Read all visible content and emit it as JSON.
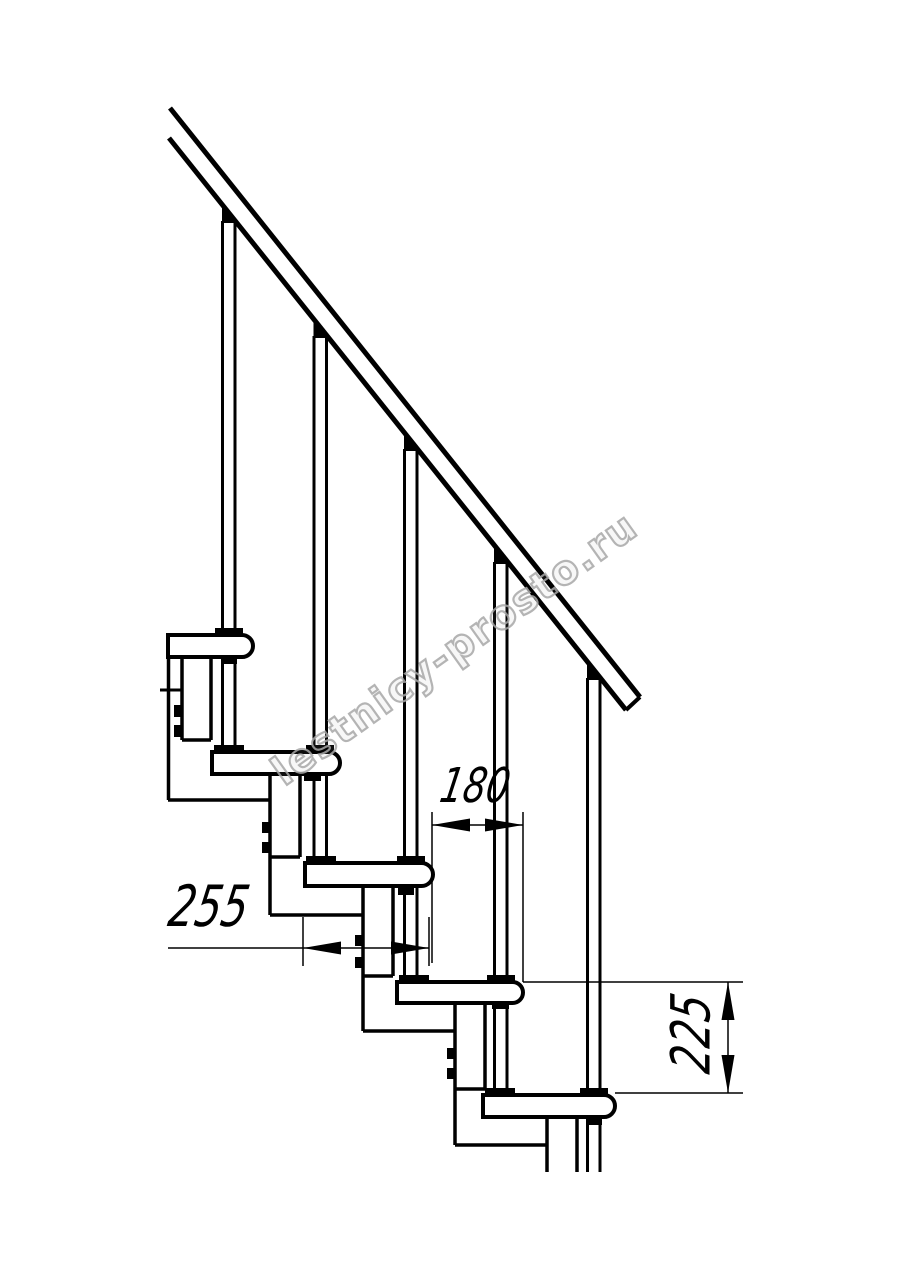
{
  "canvas": {
    "width": 914,
    "height": 1280,
    "background": "#ffffff",
    "ink": "#000000",
    "watermark_color": "#a8a8a8"
  },
  "watermark": {
    "text": "lestnicy-prosto.ru",
    "angle_deg": -35.5
  },
  "title": "Modular staircase side-view fragment with step dimensions",
  "dimensions": {
    "run_255": {
      "label": "255",
      "meaning": "tread depth, mm",
      "orientation": "horizontal"
    },
    "run_180": {
      "label": "180",
      "meaning": "step run between noses, mm",
      "orientation": "horizontal"
    },
    "rise_225": {
      "label": "225",
      "meaning": "step rise, mm",
      "orientation": "vertical-rotated"
    }
  },
  "drawing": {
    "rail_lines": [
      [
        170,
        108,
        640,
        697,
        5
      ],
      [
        169,
        138,
        626,
        710,
        5
      ],
      [
        640,
        697,
        626,
        710,
        4
      ]
    ],
    "baluster_lines": [
      [
        222.5,
        221,
        222.5,
        630,
        3
      ],
      [
        235,
        221,
        235,
        630,
        3
      ],
      [
        222.5,
        656,
        222.5,
        747,
        3
      ],
      [
        235,
        656,
        235,
        747,
        3
      ],
      [
        314,
        336,
        314,
        747,
        3
      ],
      [
        326.5,
        336,
        326.5,
        747,
        3
      ],
      [
        314,
        774,
        314,
        858,
        3
      ],
      [
        326.5,
        774,
        326.5,
        858,
        3
      ],
      [
        404.5,
        449,
        404.5,
        858,
        3
      ],
      [
        417,
        449,
        417,
        858,
        3
      ],
      [
        404.5,
        888,
        404.5,
        977,
        3
      ],
      [
        417,
        888,
        417,
        977,
        3
      ],
      [
        494.5,
        562,
        494.5,
        977,
        3
      ],
      [
        507,
        562,
        507,
        977,
        3
      ],
      [
        494.5,
        1002,
        494.5,
        1090,
        3
      ],
      [
        507,
        1002,
        507,
        1090,
        3
      ],
      [
        587.5,
        678,
        587.5,
        1090,
        3
      ],
      [
        600,
        678,
        600,
        1090,
        3
      ],
      [
        587.5,
        1117,
        587.5,
        1172,
        3
      ],
      [
        600,
        1117,
        600,
        1172,
        3
      ]
    ],
    "frame_lines": [
      [
        168.5,
        657,
        168.5,
        800,
        3.5
      ],
      [
        182,
        657,
        182,
        740,
        3.5
      ],
      [
        211,
        657,
        211,
        740,
        3.5
      ],
      [
        182,
        740,
        211,
        740,
        3.5
      ],
      [
        168,
        800,
        270,
        800,
        3.5
      ],
      [
        160,
        690,
        182,
        690,
        3
      ],
      [
        270,
        774,
        270,
        915,
        3.5
      ],
      [
        300,
        774,
        300,
        857,
        3.5
      ],
      [
        270,
        857,
        300,
        857,
        3.5
      ],
      [
        270,
        915,
        363,
        915,
        3.5
      ],
      [
        363,
        886,
        363,
        1031,
        3.5
      ],
      [
        393,
        886,
        393,
        976,
        3.5
      ],
      [
        363,
        976,
        393,
        976,
        3.5
      ],
      [
        363,
        1031,
        455,
        1031,
        3.5
      ],
      [
        455,
        1003,
        455,
        1145,
        3.5
      ],
      [
        485,
        1003,
        485,
        1089,
        3.5
      ],
      [
        455,
        1089,
        485,
        1089,
        3.5
      ],
      [
        455,
        1145,
        547,
        1145,
        3.5
      ],
      [
        547,
        1117,
        547,
        1172,
        3.5
      ],
      [
        577,
        1117,
        577,
        1172,
        3.5
      ]
    ],
    "treads": [
      [
        168,
        635,
        85,
        22
      ],
      [
        212,
        752,
        128,
        22
      ],
      [
        305,
        863,
        128,
        23
      ],
      [
        397,
        982,
        126,
        21
      ],
      [
        483,
        1095,
        132,
        22
      ]
    ],
    "fasteners": [
      [
        215,
        628,
        28,
        8
      ],
      [
        221,
        656,
        16,
        8
      ],
      [
        214,
        745,
        30,
        8
      ],
      [
        306,
        745,
        28,
        8
      ],
      [
        304,
        773,
        17,
        8
      ],
      [
        306,
        856,
        30,
        8
      ],
      [
        397,
        856,
        28,
        8
      ],
      [
        398,
        887,
        16,
        8
      ],
      [
        399,
        975,
        30,
        8
      ],
      [
        487,
        975,
        28,
        8
      ],
      [
        492,
        1001,
        17,
        8
      ],
      [
        485,
        1088,
        30,
        8
      ],
      [
        580,
        1088,
        28,
        8
      ],
      [
        586,
        1117,
        16,
        8
      ],
      [
        174,
        705,
        8,
        12
      ],
      [
        174,
        725,
        8,
        12
      ],
      [
        262,
        822,
        8,
        11
      ],
      [
        262,
        842,
        8,
        11
      ],
      [
        355,
        935,
        8,
        11
      ],
      [
        355,
        957,
        8,
        11
      ],
      [
        447,
        1048,
        8,
        11
      ],
      [
        447,
        1068,
        8,
        11
      ]
    ],
    "wedges": [
      [
        229,
        223
      ],
      [
        320.5,
        338
      ],
      [
        411,
        451
      ],
      [
        501,
        564
      ],
      [
        594,
        680
      ]
    ],
    "thin_lines": [
      [
        432,
        812,
        432,
        963,
        1.5
      ],
      [
        523,
        812,
        523,
        982,
        1.5
      ],
      [
        303,
        917,
        303,
        966,
        1.5
      ],
      [
        429,
        917,
        429,
        966,
        1.5
      ],
      [
        523,
        982,
        743,
        982,
        1.5
      ],
      [
        615,
        1093,
        743,
        1093,
        1.5
      ],
      [
        432,
        825,
        523,
        825,
        1.5
      ],
      [
        168,
        948,
        429,
        948,
        1.5
      ],
      [
        728,
        982,
        728,
        1093,
        1.5
      ]
    ],
    "arrows": [
      [
        432,
        825,
        "left"
      ],
      [
        523,
        825,
        "right"
      ],
      [
        303,
        948,
        "left"
      ],
      [
        429,
        948,
        "right"
      ],
      [
        728,
        982,
        "up"
      ],
      [
        728,
        1093,
        "down"
      ]
    ]
  }
}
